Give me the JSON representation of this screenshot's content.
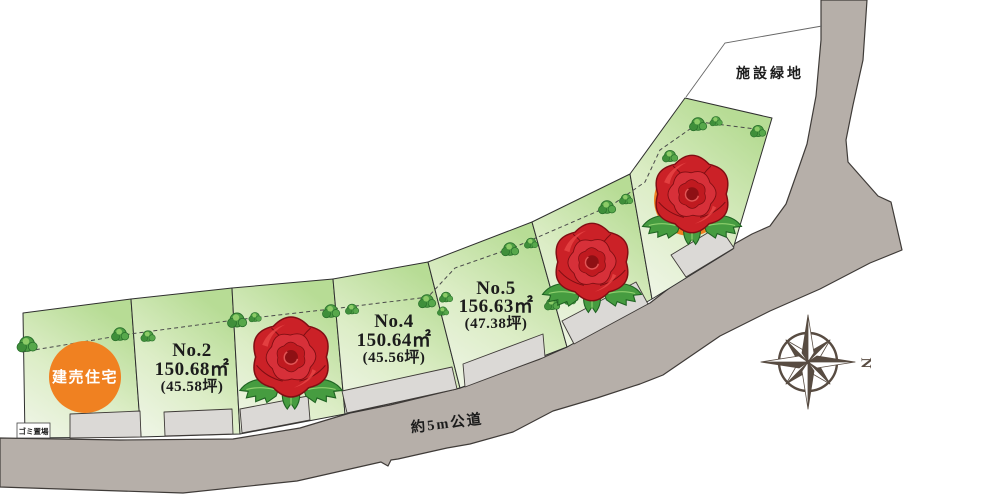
{
  "labels": {
    "green_space": "施設緑地",
    "road": "約5m公道",
    "garbage": "ゴミ置場",
    "compass_north": "N"
  },
  "lots": {
    "house": {
      "label": "建売住宅",
      "marker_color": "#f08121"
    },
    "no2": {
      "number": "No.2",
      "area": "150.68㎡",
      "tsubo": "(45.58坪)"
    },
    "no4": {
      "number": "No.4",
      "area": "150.64㎡",
      "tsubo": "(45.56坪)"
    },
    "no5": {
      "number": "No.5",
      "area": "156.63㎡",
      "tsubo": "(47.38坪)"
    },
    "sold_marker_icon": "rose-icon",
    "sold_lot_count": 3
  },
  "colors": {
    "lot_green_top": "#b7dc95",
    "lot_green_bottom": "#f1f6ea",
    "road_gray": "#b6afa9",
    "parking_gray": "#dbd9d6",
    "rose_red": "#cc2127",
    "leaf_green": "#469c40",
    "accent_orange": "#f08121",
    "compass_brown": "#584c42"
  }
}
